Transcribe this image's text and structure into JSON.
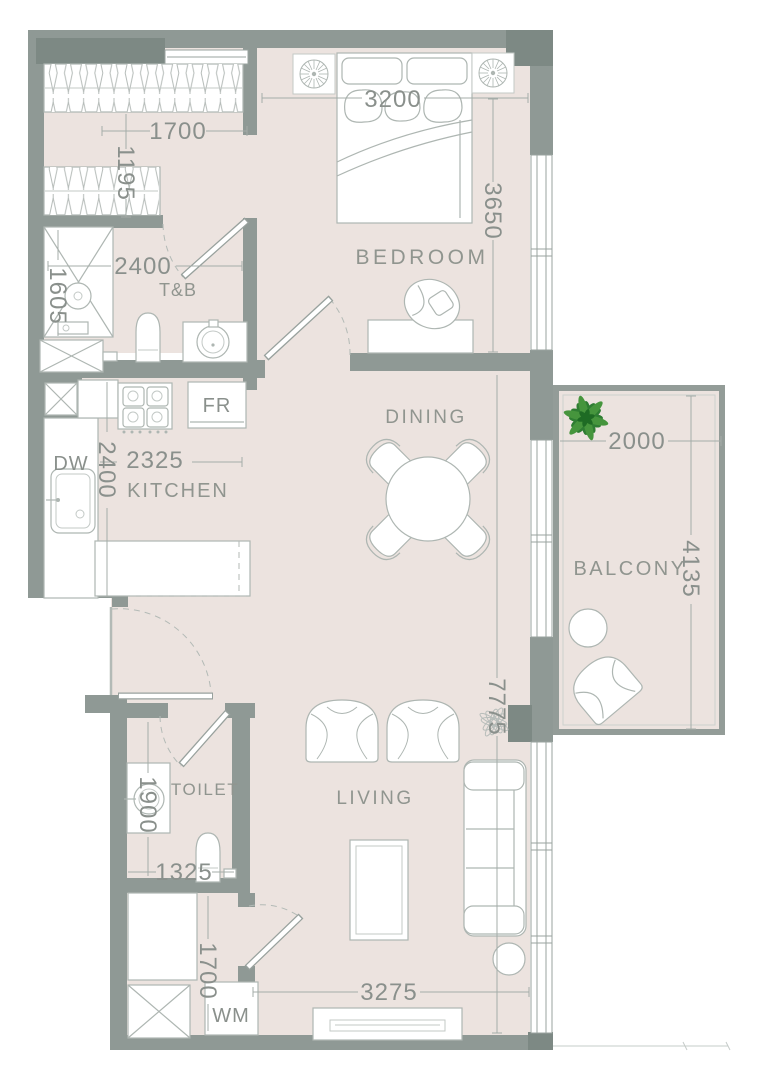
{
  "floorplan": {
    "type": "apartment-floor-plan",
    "rooms": {
      "bedroom": {
        "label": "BEDROOM"
      },
      "tnb": {
        "label": "T&B"
      },
      "kitchen": {
        "label": "KITCHEN"
      },
      "dining": {
        "label": "DINING"
      },
      "balcony": {
        "label": "BALCONY"
      },
      "toilet": {
        "label": "TOILET"
      },
      "living": {
        "label": "LIVING"
      }
    },
    "appliances": {
      "fridge": {
        "label": "FR"
      },
      "dishwasher": {
        "label": "DW"
      },
      "washing_machine": {
        "label": "WM"
      }
    },
    "dimensions_mm": {
      "closet_width": "1700",
      "closet_depth": "1195",
      "shower_width": "1605",
      "tnb_width": "2400",
      "bedroom_width": "3200",
      "bedroom_depth": "3650",
      "kitchen_width": "2325",
      "kitchen_depth": "2400",
      "balcony_width": "2000",
      "balcony_depth": "4135",
      "unit_depth": "7775",
      "toilet_depth": "1900",
      "toilet_width": "1325",
      "utility_width": "1700",
      "living_width": "3275"
    },
    "colors": {
      "wall": "#8f9995",
      "wall_dark": "#7d8984",
      "floor": "#ece3df",
      "furniture_line": "#aeb6b2",
      "dimension_text": "#8a908c",
      "plant_green": "#2f7d33",
      "background": "#ffffff"
    }
  }
}
